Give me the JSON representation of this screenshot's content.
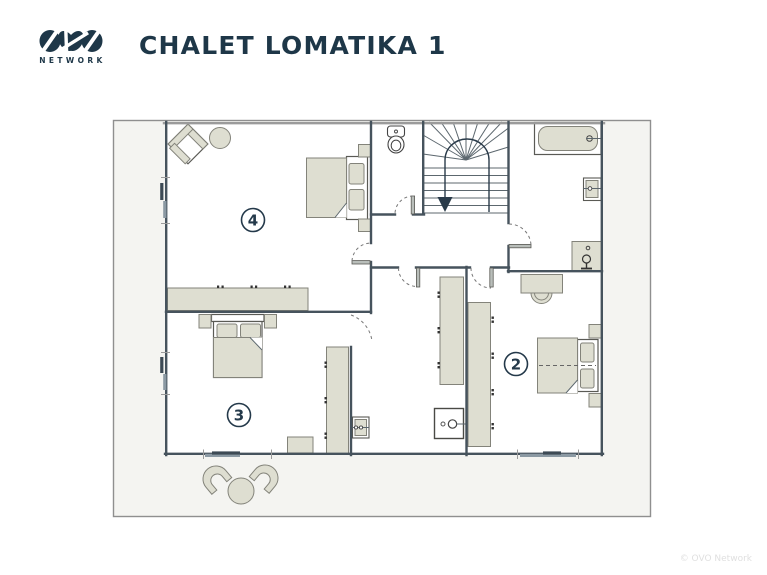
{
  "header": {
    "logo": {
      "brand": "OVO",
      "subtext": "NETWORK",
      "icon": "ovo-logo-mark"
    },
    "title": "CHALET LOMATIKA 1"
  },
  "floorplan": {
    "room_labels": {
      "bedroom2": "2",
      "bedroom3": "3",
      "bedroom4": "4"
    },
    "features": [
      "staircase",
      "toilet",
      "bathtub",
      "bathroom-sink",
      "towel-radiator",
      "desk-with-chair",
      "double-bed-bedroom4",
      "double-bed-bedroom3",
      "double-bed-bedroom2",
      "wardrobes",
      "utility-washbasin",
      "sideboard-counter",
      "armchair",
      "side-table",
      "terrace-chairs",
      "terrace-table"
    ]
  },
  "footer": {
    "copyright": "© OVO Network"
  },
  "colors": {
    "brand_navy": "#1e3748",
    "wall": "#46535d",
    "furniture_fill": "#deded1",
    "plan_background": "#f4f4f1",
    "footer_text": "#e0e0e0"
  }
}
